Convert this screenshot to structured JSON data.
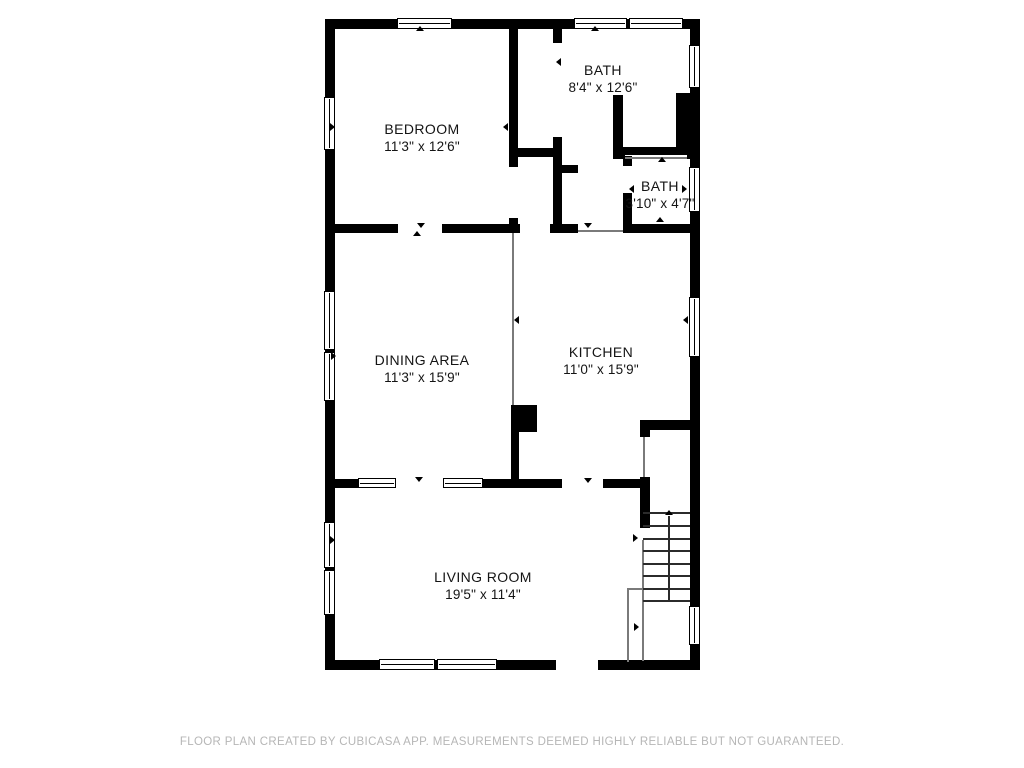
{
  "footer": {
    "text": "FLOOR PLAN CREATED BY CUBICASA APP. MEASUREMENTS DEEMED HIGHLY RELIABLE BUT NOT GUARANTEED.",
    "y": 736
  },
  "rooms": [
    {
      "name": "BEDROOM",
      "dims": "11'3\" x 12'6\"",
      "cx": 422,
      "cy": 121
    },
    {
      "name": "BATH",
      "dims": "8'4\" x 12'6\"",
      "cx": 603,
      "cy": 62
    },
    {
      "name": "BATH",
      "dims": "3'10\" x 4'7\"",
      "cx": 660,
      "cy": 178
    },
    {
      "name": "DINING AREA",
      "dims": "11'3\" x 15'9\"",
      "cx": 422,
      "cy": 352
    },
    {
      "name": "KITCHEN",
      "dims": "11'0\" x 15'9\"",
      "cx": 601,
      "cy": 344
    },
    {
      "name": "LIVING ROOM",
      "dims": "19'5\" x 11'4\"",
      "cx": 483,
      "cy": 569
    }
  ],
  "plan": {
    "wall_color": "#000000",
    "walls": [
      {
        "x": 325,
        "y": 19,
        "w": 375,
        "h": 10
      },
      {
        "x": 325,
        "y": 19,
        "w": 10,
        "h": 651
      },
      {
        "x": 325,
        "y": 660,
        "w": 375,
        "h": 10
      },
      {
        "x": 690,
        "y": 19,
        "w": 10,
        "h": 651
      },
      {
        "x": 509,
        "y": 27,
        "w": 9,
        "h": 125
      },
      {
        "x": 509,
        "y": 157,
        "w": 9,
        "h": 10
      },
      {
        "x": 509,
        "y": 218,
        "w": 9,
        "h": 15
      },
      {
        "x": 509,
        "y": 148,
        "w": 49,
        "h": 9
      },
      {
        "x": 553,
        "y": 19,
        "w": 9,
        "h": 24
      },
      {
        "x": 553,
        "y": 137,
        "w": 9,
        "h": 87
      },
      {
        "x": 558,
        "y": 165,
        "w": 20,
        "h": 8
      },
      {
        "x": 613,
        "y": 95,
        "w": 10,
        "h": 57
      },
      {
        "x": 613,
        "y": 147,
        "w": 87,
        "h": 8
      },
      {
        "x": 613,
        "y": 147,
        "w": 12,
        "h": 12
      },
      {
        "x": 687,
        "y": 147,
        "w": 13,
        "h": 12
      },
      {
        "x": 676,
        "y": 93,
        "w": 24,
        "h": 60
      },
      {
        "x": 623,
        "y": 156,
        "w": 9,
        "h": 10
      },
      {
        "x": 623,
        "y": 193,
        "w": 9,
        "h": 40
      },
      {
        "x": 325,
        "y": 224,
        "w": 73,
        "h": 9
      },
      {
        "x": 442,
        "y": 224,
        "w": 78,
        "h": 9
      },
      {
        "x": 550,
        "y": 224,
        "w": 28,
        "h": 9
      },
      {
        "x": 623,
        "y": 224,
        "w": 77,
        "h": 9
      },
      {
        "x": 511,
        "y": 405,
        "w": 26,
        "h": 27
      },
      {
        "x": 511,
        "y": 432,
        "w": 8,
        "h": 48
      },
      {
        "x": 325,
        "y": 479,
        "w": 33,
        "h": 9
      },
      {
        "x": 483,
        "y": 479,
        "w": 79,
        "h": 9
      },
      {
        "x": 603,
        "y": 479,
        "w": 45,
        "h": 9
      },
      {
        "x": 640,
        "y": 420,
        "w": 60,
        "h": 10
      },
      {
        "x": 640,
        "y": 430,
        "w": 10,
        "h": 7
      },
      {
        "x": 640,
        "y": 477,
        "w": 10,
        "h": 51
      }
    ],
    "door_gaps": [
      {
        "x": 556,
        "y": 659,
        "w": 42,
        "h": 12
      }
    ],
    "windows": [
      {
        "x": 397,
        "y": 18,
        "w": 55,
        "h": 11,
        "o": "h"
      },
      {
        "x": 574,
        "y": 18,
        "w": 53,
        "h": 11,
        "o": "h"
      },
      {
        "x": 629,
        "y": 18,
        "w": 54,
        "h": 11,
        "o": "h"
      },
      {
        "x": 324,
        "y": 97,
        "w": 11,
        "h": 53,
        "o": "v"
      },
      {
        "x": 324,
        "y": 291,
        "w": 11,
        "h": 59,
        "o": "v"
      },
      {
        "x": 324,
        "y": 352,
        "w": 11,
        "h": 49,
        "o": "v"
      },
      {
        "x": 324,
        "y": 522,
        "w": 11,
        "h": 46,
        "o": "v"
      },
      {
        "x": 324,
        "y": 570,
        "w": 11,
        "h": 45,
        "o": "v"
      },
      {
        "x": 379,
        "y": 659,
        "w": 56,
        "h": 11,
        "o": "h"
      },
      {
        "x": 437,
        "y": 659,
        "w": 60,
        "h": 11,
        "o": "h"
      },
      {
        "x": 689,
        "y": 45,
        "w": 11,
        "h": 43,
        "o": "v"
      },
      {
        "x": 689,
        "y": 167,
        "w": 11,
        "h": 45,
        "o": "v"
      },
      {
        "x": 689,
        "y": 297,
        "w": 11,
        "h": 60,
        "o": "v"
      },
      {
        "x": 689,
        "y": 606,
        "w": 11,
        "h": 39,
        "o": "v"
      },
      {
        "x": 358,
        "y": 478,
        "w": 38,
        "h": 10,
        "o": "h"
      },
      {
        "x": 443,
        "y": 478,
        "w": 40,
        "h": 10,
        "o": "h"
      }
    ],
    "thin_lines": [
      {
        "x": 512,
        "y": 233,
        "w": 2,
        "h": 172
      },
      {
        "x": 643,
        "y": 437,
        "w": 2,
        "h": 40
      },
      {
        "x": 642,
        "y": 540,
        "w": 2,
        "h": 121
      },
      {
        "x": 627,
        "y": 588,
        "w": 2,
        "h": 74
      },
      {
        "x": 627,
        "y": 588,
        "w": 16,
        "h": 2
      },
      {
        "x": 578,
        "y": 230,
        "w": 45,
        "h": 2
      },
      {
        "x": 625,
        "y": 157,
        "w": 62,
        "h": 1.5
      }
    ],
    "markers": [
      {
        "x": 420,
        "y": 30,
        "dir": "up"
      },
      {
        "x": 595,
        "y": 30,
        "dir": "up"
      },
      {
        "x": 334,
        "y": 127,
        "dir": "right"
      },
      {
        "x": 507,
        "y": 127,
        "dir": "left"
      },
      {
        "x": 560,
        "y": 62,
        "dir": "left"
      },
      {
        "x": 633,
        "y": 189,
        "dir": "left"
      },
      {
        "x": 686,
        "y": 189,
        "dir": "right"
      },
      {
        "x": 662,
        "y": 161,
        "dir": "up"
      },
      {
        "x": 660,
        "y": 221,
        "dir": "up"
      },
      {
        "x": 421,
        "y": 227,
        "dir": "down"
      },
      {
        "x": 417,
        "y": 235,
        "dir": "up"
      },
      {
        "x": 588,
        "y": 227,
        "dir": "down"
      },
      {
        "x": 518,
        "y": 320,
        "dir": "left"
      },
      {
        "x": 687,
        "y": 320,
        "dir": "left"
      },
      {
        "x": 335,
        "y": 356,
        "dir": "right"
      },
      {
        "x": 588,
        "y": 482,
        "dir": "down"
      },
      {
        "x": 419,
        "y": 481,
        "dir": "down"
      },
      {
        "x": 637,
        "y": 538,
        "dir": "right"
      },
      {
        "x": 638,
        "y": 627,
        "dir": "right"
      },
      {
        "x": 334,
        "y": 540,
        "dir": "right"
      }
    ],
    "stairs": {
      "x": 643,
      "w": 47,
      "treads_y": [
        512,
        525,
        538,
        550,
        563,
        575,
        588,
        600
      ],
      "arrow": {
        "x": 668,
        "y_top": 516,
        "y_bottom": 600
      }
    }
  }
}
